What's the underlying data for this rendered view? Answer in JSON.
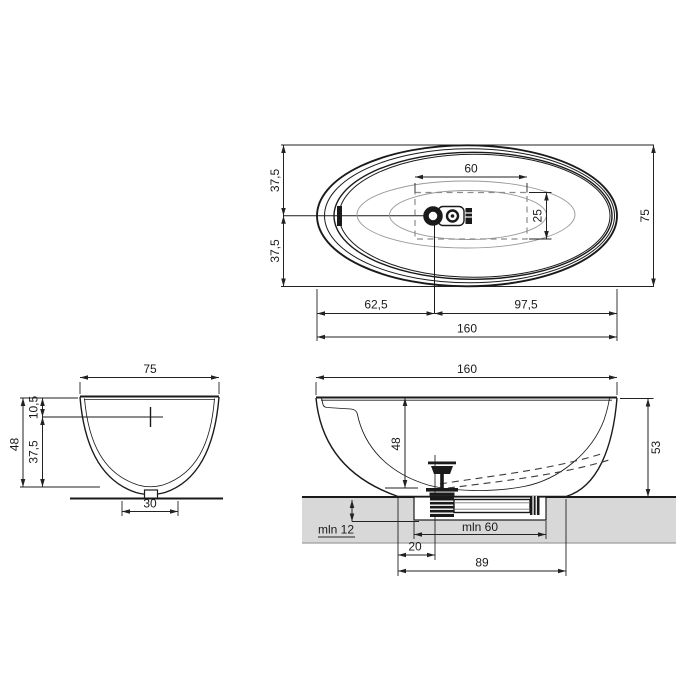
{
  "title": "Bathtub technical dimension drawing",
  "colors": {
    "floor": "#d8d8d8",
    "floor_edge": "#9e9e9e",
    "line": "#1a1a1a"
  },
  "plan_view": {
    "width_half_top": "37,5",
    "width_half_bottom": "37,5",
    "inner_length": "60",
    "inner_width": "25",
    "overall_width": "75",
    "drain_from_left_end": "62,5",
    "drain_to_right_end": "97,5",
    "overall_length": "160"
  },
  "end_view": {
    "overall_width": "75",
    "rim_to_drain_axis": "10,5",
    "drain_axis_to_bottom": "37,5",
    "inner_depth": "48",
    "base_width": "30"
  },
  "side_view": {
    "overall_length": "160",
    "inner_depth": "48",
    "overall_height": "53",
    "min_recess_depth": "mln 12",
    "min_recess_length": "mln 60",
    "base_edge_to_drain": "20",
    "base_length": "89"
  }
}
